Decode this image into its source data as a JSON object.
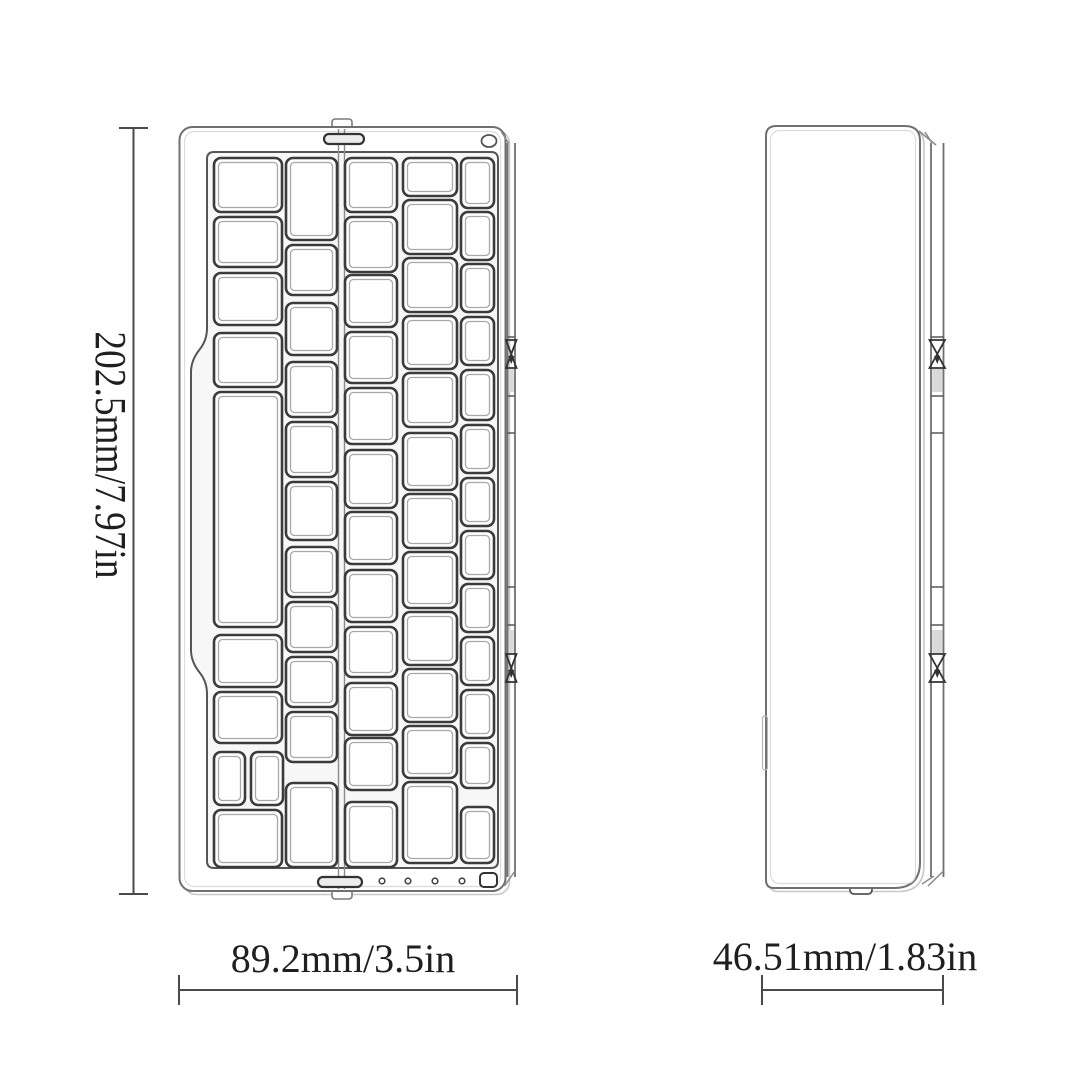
{
  "figure": {
    "type": "product-dimension-diagram",
    "subject": "folding bluetooth keyboard line drawing, top view and side view",
    "background": "#ffffff",
    "ink": "#3b3b3b"
  },
  "dimensions": {
    "height_label": "202.5mm/7.97in",
    "width_label": "89.2mm/3.5in",
    "depth_label": "46.51mm/1.83in"
  },
  "top_view": {
    "key_columns": [
      {
        "x": 214,
        "w": 68,
        "keys": [
          [
            158,
            54
          ],
          [
            217,
            50
          ],
          [
            273,
            52
          ],
          [
            333,
            54
          ],
          [
            392,
            235
          ],
          [
            635,
            52
          ],
          [
            692,
            51
          ],
          [
            752,
            53,
            31,
            0
          ],
          [
            752,
            53,
            32,
            37
          ],
          [
            810,
            57
          ]
        ]
      },
      {
        "x": 286,
        "w": 51,
        "keys": [
          [
            158,
            82
          ],
          [
            245,
            50
          ],
          [
            303,
            52
          ],
          [
            362,
            55
          ],
          [
            422,
            55
          ],
          [
            482,
            58
          ],
          [
            547,
            50
          ],
          [
            602,
            50
          ],
          [
            657,
            50
          ],
          [
            712,
            50
          ],
          [
            783,
            84
          ]
        ]
      },
      {
        "x": 345,
        "w": 52,
        "keys": [
          [
            158,
            54
          ],
          [
            217,
            55
          ],
          [
            275,
            52
          ],
          [
            332,
            51
          ],
          [
            388,
            56
          ],
          [
            450,
            58
          ],
          [
            512,
            52
          ],
          [
            570,
            52
          ],
          [
            627,
            50
          ],
          [
            683,
            52
          ],
          [
            738,
            52
          ],
          [
            802,
            65
          ]
        ]
      },
      {
        "x": 403,
        "w": 54,
        "keys": [
          [
            158,
            38
          ],
          [
            200,
            54
          ],
          [
            258,
            54
          ],
          [
            316,
            53
          ],
          [
            373,
            54
          ],
          [
            433,
            57
          ],
          [
            494,
            54
          ],
          [
            552,
            56
          ],
          [
            612,
            53
          ],
          [
            669,
            53
          ],
          [
            726,
            52
          ],
          [
            782,
            81
          ]
        ]
      },
      {
        "x": 461,
        "w": 33,
        "keys": [
          [
            158,
            50
          ],
          [
            212,
            48
          ],
          [
            264,
            48
          ],
          [
            317,
            48
          ],
          [
            370,
            50
          ],
          [
            425,
            48
          ],
          [
            478,
            48
          ],
          [
            531,
            48
          ],
          [
            584,
            48
          ],
          [
            637,
            48
          ],
          [
            690,
            48
          ],
          [
            743,
            45
          ],
          [
            807,
            56
          ]
        ]
      }
    ],
    "led_x": [
      382,
      408,
      435,
      462
    ],
    "led_y": 881
  },
  "hinge_strips": [
    {
      "x": 507.5,
      "w": 7.5
    },
    {
      "x": 931.0,
      "w": 12.5
    }
  ],
  "hinge_strip_pattern": {
    "y_top": 143,
    "y_bottom": 877,
    "joints": [
      337,
      396,
      433,
      587,
      625
    ],
    "knots": [
      340,
      654
    ],
    "pads": [
      369,
      630
    ]
  }
}
